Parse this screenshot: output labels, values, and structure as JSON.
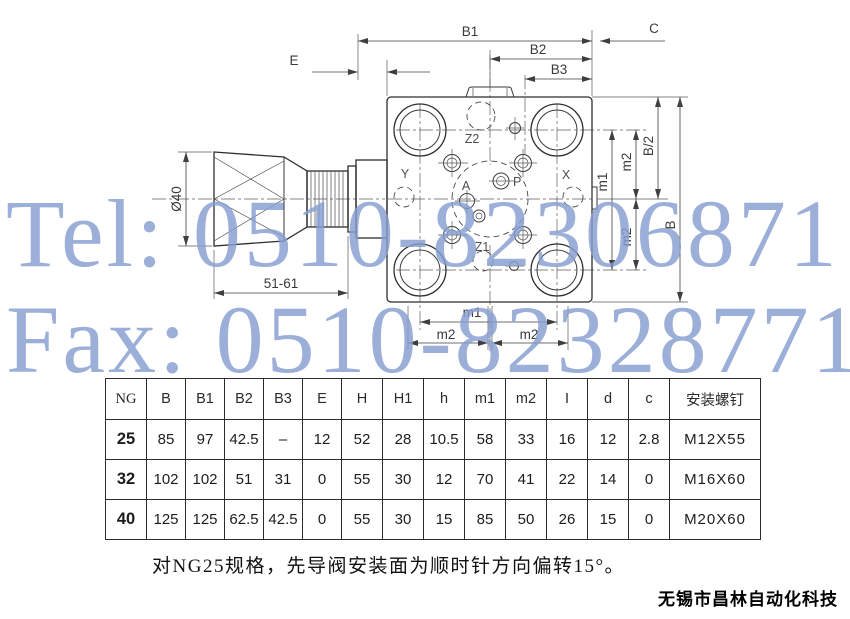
{
  "watermark": {
    "tel": "Tel: 0510-82306871",
    "fax": "Fax: 0510-82328771",
    "color": "#869ed1"
  },
  "drawing": {
    "labels": {
      "b1": "B1",
      "b2": "B2",
      "b3": "B3",
      "c": "C",
      "e": "E",
      "dia40": "Ø40",
      "range": "51-61",
      "m1": "m1",
      "m2": "m2",
      "b_half": "B/2",
      "b": "B",
      "z2": "Z2",
      "z1": "Z1",
      "x": "X",
      "y": "Y",
      "a": "A",
      "p": "P"
    }
  },
  "table": {
    "headers": [
      "NG",
      "B",
      "B1",
      "B2",
      "B3",
      "E",
      "H",
      "H1",
      "h",
      "m1",
      "m2",
      "I",
      "d",
      "c",
      "安装螺钉"
    ],
    "rows": [
      {
        "ng": "25",
        "cells": [
          "85",
          "97",
          "42.5",
          "–",
          "12",
          "52",
          "28",
          "10.5",
          "58",
          "33",
          "16",
          "12",
          "2.8",
          "M12X55"
        ]
      },
      {
        "ng": "32",
        "cells": [
          "102",
          "102",
          "51",
          "31",
          "0",
          "55",
          "30",
          "12",
          "70",
          "41",
          "22",
          "14",
          "0",
          "M16X60"
        ]
      },
      {
        "ng": "40",
        "cells": [
          "125",
          "125",
          "62.5",
          "42.5",
          "0",
          "55",
          "30",
          "15",
          "85",
          "50",
          "26",
          "15",
          "0",
          "M20X60"
        ]
      }
    ]
  },
  "note": "对NG25规格，先导阀安装面为顺时针方向偏转15°。",
  "company": "无锡市昌林自动化科技"
}
